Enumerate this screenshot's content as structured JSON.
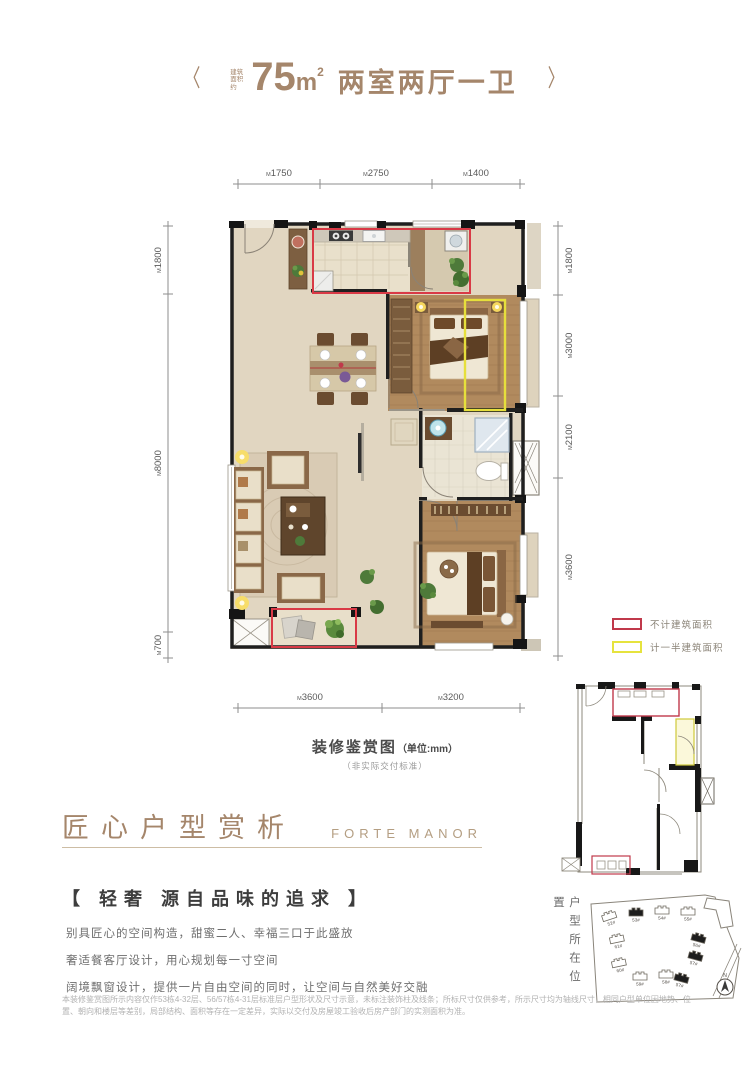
{
  "accent": "#a5866b",
  "header": {
    "prev_icon": "〈",
    "next_icon": "〉",
    "area_prefix": "建筑面积约",
    "area_value": "75",
    "area_unit": "m",
    "area_sup": "2",
    "layout_title": "两室两厅一卫"
  },
  "plan": {
    "caption": "装修鉴赏图",
    "caption_unit": "（单位:mm）",
    "caption_note": "（非实际交付标准）",
    "dim_prefix": "M",
    "dims_top": [
      "1750",
      "2750",
      "1400"
    ],
    "dims_left": [
      "1800",
      "8000",
      "700"
    ],
    "dims_right": [
      "1800",
      "3000",
      "2100",
      "3600"
    ],
    "dims_bottom": [
      "3600",
      "3200"
    ]
  },
  "legend": {
    "items": [
      {
        "label": "不计建筑面积",
        "color": "#c0394b"
      },
      {
        "label": "计一半建筑面积",
        "color": "#e6e33e"
      }
    ]
  },
  "location": {
    "title": "户型所在位置",
    "compass_label": "N",
    "buildings": [
      {
        "label": "52#",
        "filled": false
      },
      {
        "label": "53#",
        "filled": true
      },
      {
        "label": "54#",
        "filled": false
      },
      {
        "label": "55#",
        "filled": false
      },
      {
        "label": "61#",
        "filled": false
      },
      {
        "label": "60#",
        "filled": false
      },
      {
        "label": "59#",
        "filled": false
      },
      {
        "label": "58#",
        "filled": false
      },
      {
        "label": "56#",
        "filled": true
      },
      {
        "label": "57#",
        "filled": true
      },
      {
        "label": "57#",
        "filled": true
      }
    ]
  },
  "section": {
    "title": "匠心户型赏析",
    "subtitle": "FORTE MANOR"
  },
  "feature": {
    "heading": "【 轻奢  源自品味的追求 】",
    "lines": [
      "别具匠心的空间构造，甜蜜二人、幸福三口于此盛放",
      "奢适餐客厅设计，用心规划每一寸空间",
      "阔境飘窗设计，提供一片自由空间的同时，让空间与自然美好交融"
    ]
  },
  "disclaimer": "本装修鉴赏图所示内容仅作53栋4-32层、56/57栋4-31层标准层户型形状及尺寸示意，未标注装饰柱及线条；所标尺寸仅供参考，所示尺寸均为轴线尺寸，相同户型单位因地势、位置、朝向和楼层等差别，局部结构、面积等存在一定差异，实际以交付及房屋竣工验收后房产部门的实测面积为准。"
}
